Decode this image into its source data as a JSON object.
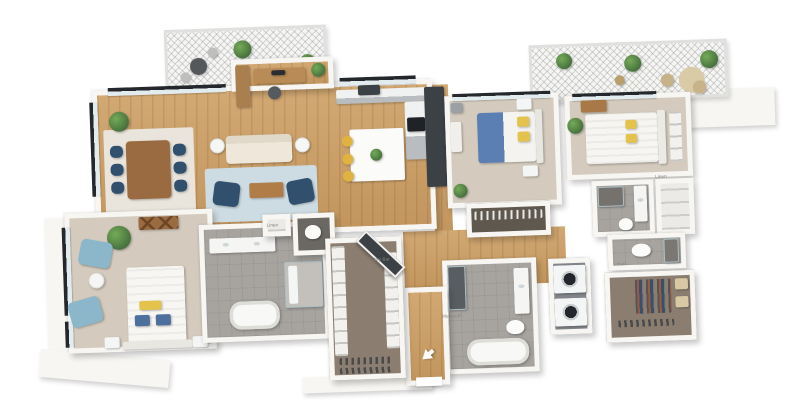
{
  "scene": {
    "description": "3D isometric rendering of a three-bedroom, multi-bath apartment floor plan on a white background",
    "background": "#ffffff"
  },
  "labels": {
    "linen_master": "Linen",
    "dry_bar": "Dry Bar",
    "mudroom": "Mudroom",
    "linen_hall": "Linen",
    "linen_bedroom3": "Linen"
  },
  "palette": {
    "wall": "#f7f6f3",
    "wood": "#d2a873",
    "wood_dark": "#c2965e",
    "carpet": "#d4cbbe",
    "tile": "#a7a4a0",
    "tile_dark": "#6b6864",
    "closet_floor": "#8b7e71",
    "rug_blue": "#cddbe2",
    "rug_cream": "#e9e5dc",
    "sofa_cream": "#efe8da",
    "navy": "#30506e",
    "light_blue": "#8cb6c9",
    "bed_blue": "#5b7fb3",
    "pillow_yellow": "#e3c34c",
    "stool_yellow": "#e0b23f",
    "plant": "#456f3c",
    "cabinet_dark": "#3c4146",
    "dresser_wood": "#9a6a40"
  },
  "rooms": [
    {
      "name": "balcony-left",
      "floor": "deck"
    },
    {
      "name": "office-nook",
      "floor": "wood"
    },
    {
      "name": "living-dining-room",
      "floor": "wood"
    },
    {
      "name": "kitchen",
      "floor": "wood"
    },
    {
      "name": "hallway-foyer",
      "floor": "wood"
    },
    {
      "name": "bedroom-2",
      "floor": "carpet"
    },
    {
      "name": "closet-bedroom-2",
      "floor": "dark-carpet"
    },
    {
      "name": "bedroom-3",
      "floor": "carpet"
    },
    {
      "name": "bathroom-3",
      "floor": "tile"
    },
    {
      "name": "linen-closet",
      "floor": "shelving"
    },
    {
      "name": "balcony-right",
      "floor": "deck"
    },
    {
      "name": "laundry-closet",
      "floor": "tile"
    },
    {
      "name": "mudroom-bathroom",
      "floor": "tile"
    },
    {
      "name": "walk-in-closet-2",
      "floor": "dark-carpet"
    },
    {
      "name": "master-bedroom",
      "floor": "carpet"
    },
    {
      "name": "master-bathroom",
      "floor": "tile"
    },
    {
      "name": "water-closet",
      "floor": "dark-tile"
    },
    {
      "name": "master-walk-in-closet",
      "floor": "dark-carpet"
    },
    {
      "name": "entry",
      "floor": "wood"
    }
  ]
}
